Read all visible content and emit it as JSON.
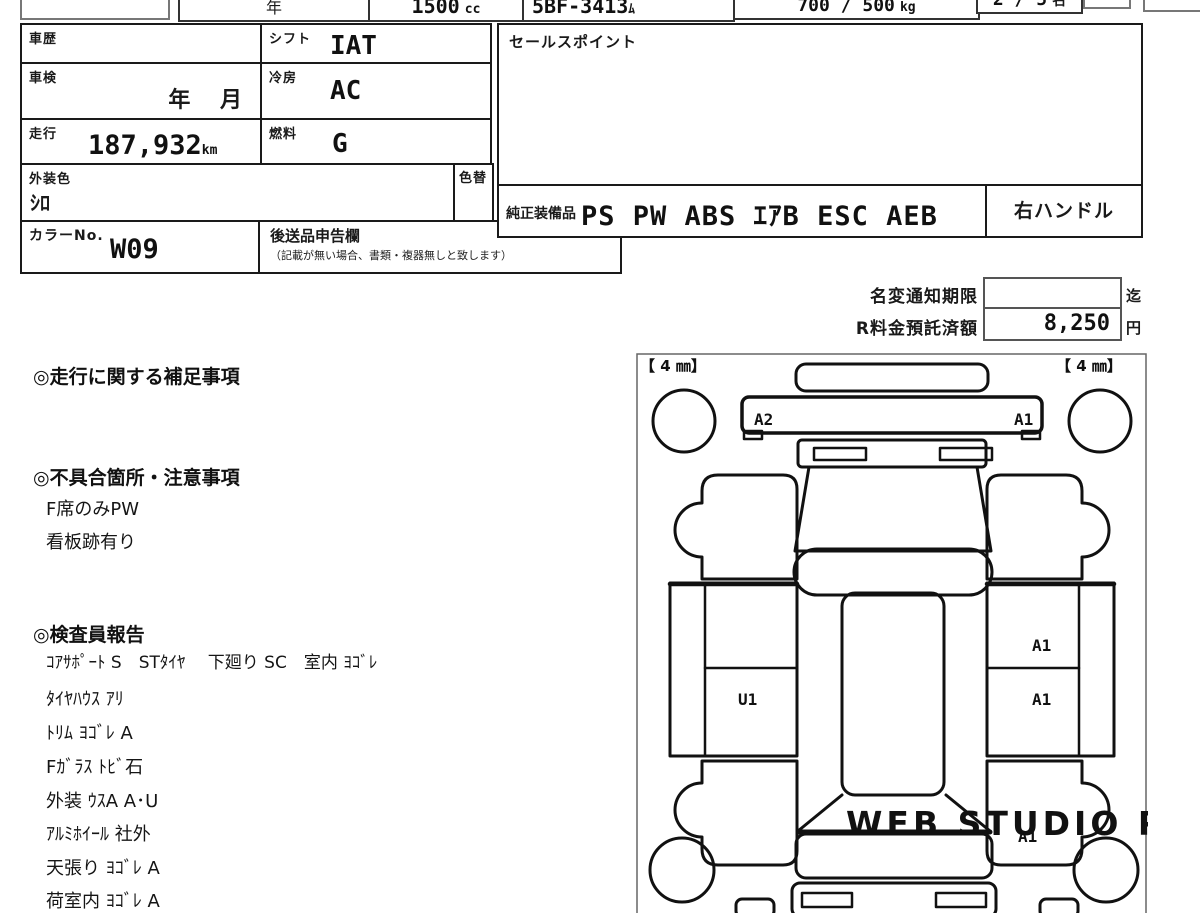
{
  "header": {
    "year_suffix": "年",
    "displacement_value": "1500",
    "displacement_unit": "cc",
    "model_code": "5BF-3413",
    "model_code_suffix": "ﾑ",
    "load_value": "700 / 500",
    "load_unit": "kg",
    "capacity_value": "2 / 5",
    "capacity_unit": "名"
  },
  "table": {
    "history": {
      "label": "車歴",
      "value": ""
    },
    "shift": {
      "label": "シフト",
      "value": "IAT"
    },
    "shaken": {
      "label": "車検",
      "value": "年　 月"
    },
    "cooling": {
      "label": "冷房",
      "value": "AC"
    },
    "mileage": {
      "label": "走行",
      "value": "187,932",
      "unit": "km"
    },
    "fuel": {
      "label": "燃料",
      "value": "G"
    },
    "ext_color": {
      "label": "外装色",
      "value": "ｼﾛ"
    },
    "color_change": {
      "label": "色替"
    },
    "color_no": {
      "label": "カラーNo.",
      "value": "W09"
    },
    "shipping": {
      "label": "後送品申告欄",
      "note": "（記載が無い場合、書類・複器無しと致します）"
    }
  },
  "sales_point": {
    "label": "セールスポイント",
    "content": ""
  },
  "equipment": {
    "label": "純正装備品",
    "items": "PS PW ABS ｴｱB ESC AEB",
    "steering": "右ハンドル"
  },
  "fees": {
    "name_change": {
      "label": "名変通知期限",
      "value": "",
      "suffix": "迄"
    },
    "recycle": {
      "label": "R料金預託済額",
      "value": "8,250",
      "suffix": "円"
    }
  },
  "notes": {
    "running_title": "◎走行に関する補足事項",
    "defects_title": "◎不具合箇所・注意事項",
    "defects": [
      "F席のみPW",
      "看板跡有り"
    ],
    "inspector_title": "◎検査員報告",
    "inspector_lines": [
      "ｺｱｻﾎﾟｰﾄ S　STﾀｲﾔ　 下廻り SC　室内 ﾖｺﾞﾚ",
      "ﾀｲﾔﾊｳｽ ｱﾘ",
      "ﾄﾘﾑ ﾖｺﾞﾚ A",
      "Fｶﾞﾗｽ ﾄﾋﾞ石",
      "外装 ｳｽA A･U",
      "ｱﾙﾐﾎｲｰﾙ 社外",
      "天張り ﾖｺﾞﾚ A",
      "荷室内 ﾖｺﾞﾚ A"
    ]
  },
  "diagram": {
    "tread_left": "【 4 ㎜】",
    "tread_right": "【 4 ㎜】",
    "marks": [
      {
        "code": "A2",
        "area": "cowl-left"
      },
      {
        "code": "A1",
        "area": "cowl-right"
      },
      {
        "code": "A1",
        "area": "right-panel-upper"
      },
      {
        "code": "A1",
        "area": "right-panel-lower"
      },
      {
        "code": "U1",
        "area": "left-panel-lower"
      },
      {
        "code": "A1",
        "area": "rear-right-quarter"
      }
    ],
    "watermark": "WEB STUDIO PRO"
  }
}
